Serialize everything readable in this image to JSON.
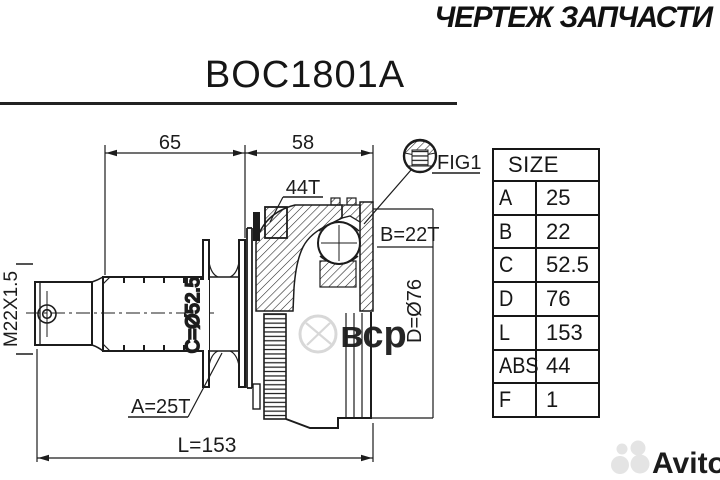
{
  "header": {
    "title": "ЧЕРТЕЖ ЗАПЧАСТИ"
  },
  "part_number": "BOC1801A",
  "drawing": {
    "dim_top_left": "65",
    "dim_top_right": "58",
    "label_abs_teeth": "44T",
    "label_fig": "FIG1",
    "label_outer_spline": "B=22T",
    "label_outer_diameter": "D=Ø76",
    "label_boot_diameter": "C=Ø52.5",
    "label_thread": "M22X1.5",
    "label_inner_spline": "A=25T",
    "label_length": "L=153"
  },
  "size_table": {
    "header": "SIZE",
    "rows": [
      {
        "key": "A",
        "value": "25"
      },
      {
        "key": "B",
        "value": "22"
      },
      {
        "key": "C",
        "value": "52.5"
      },
      {
        "key": "D",
        "value": "76"
      },
      {
        "key": "L",
        "value": "153"
      },
      {
        "key": "ABS",
        "value": "44"
      },
      {
        "key": "F",
        "value": "1"
      }
    ]
  },
  "watermarks": {
    "center_logo_text": "вср",
    "brand": "Avito"
  },
  "colors": {
    "ink": "#1c1c1c",
    "watermark_center": "#d6d6d6",
    "watermark_brand": "#e4e4e4",
    "background": "#ffffff"
  }
}
